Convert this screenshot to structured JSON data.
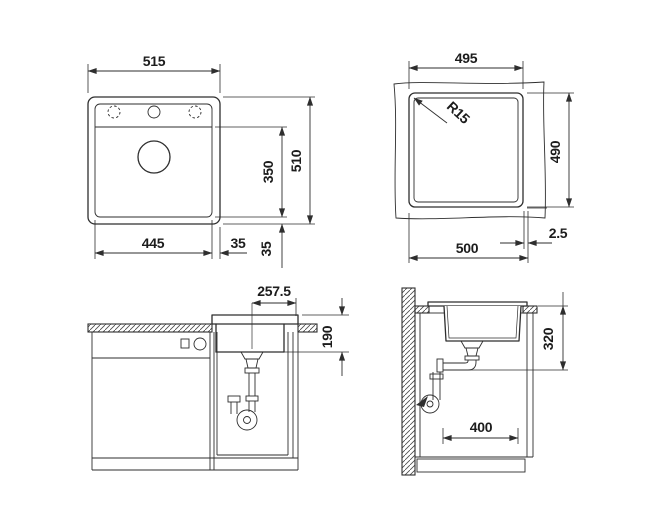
{
  "colors": {
    "line": "#2e2e2e",
    "background": "#ffffff"
  },
  "top_view": {
    "overall_width": "515",
    "overall_height": "510",
    "bowl_width": "445",
    "bowl_height": "350",
    "edge_right": "35",
    "edge_bottom": "35"
  },
  "cutout_view": {
    "cutout_width": "495",
    "cutout_height": "490",
    "corner_radius": "R15",
    "underside_width": "500",
    "side_clearance": "2.5"
  },
  "front_view": {
    "center_to_edge": "257.5",
    "bowl_depth": "190"
  },
  "side_view": {
    "outlet_height": "320",
    "bowl_length": "400"
  }
}
